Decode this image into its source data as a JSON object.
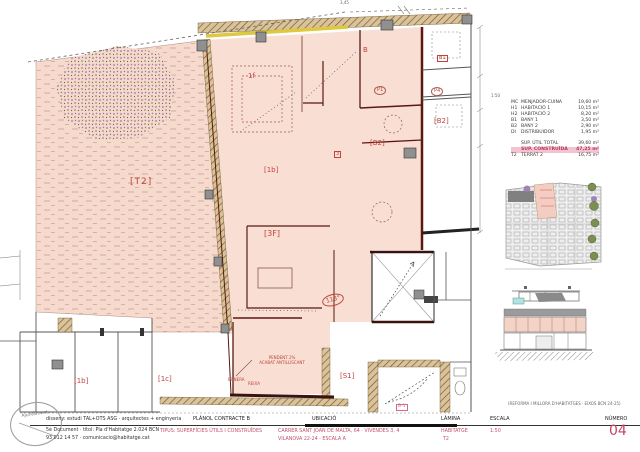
{
  "plan": {
    "labels": {
      "t2": "[T2]",
      "room_1f": "1f",
      "room_b": "B",
      "p1": "P1",
      "b2_right_top": "[B2]",
      "box_3": "3",
      "room_1b_mid": "[1b]",
      "room_3f": "[3F]",
      "angle": "113°",
      "pend_line1": "PENDENT 2%",
      "pend_line2": "ACABAT ANTILLISCANT",
      "drain_left": "BUNERA",
      "drain_right": "REIXA",
      "s1": "[S1]",
      "stair_tag": "B-1",
      "nb_b1": "B1",
      "nb_p4": "P4",
      "nb_b2": "[B2]",
      "nb_1b": "[1b]",
      "nb_1c": "[1c]",
      "dim_top": "3,45",
      "scale_note": "1:50"
    }
  },
  "legend": {
    "rows": [
      {
        "code": "MC",
        "name": "MENJADOR-CUINA",
        "area": "19,60 m²"
      },
      {
        "code": "H1",
        "name": "HABITACIÓ 1",
        "area": "10,15 m²"
      },
      {
        "code": "H2",
        "name": "HABITACIÓ 2",
        "area": "8,20 m²"
      },
      {
        "code": "B1",
        "name": "BANY 1",
        "area": "3,50 m²"
      },
      {
        "code": "B2",
        "name": "BANY 2",
        "area": "2,90 m²"
      },
      {
        "code": "DI",
        "name": "DISTRIBUIDOR",
        "area": "1,95 m²"
      }
    ],
    "totals": [
      {
        "code": "",
        "name": "SUP. ÚTIL TOTAL",
        "area": "39,60 m²"
      },
      {
        "code": "",
        "name": "SUP. CONSTRUÏDA",
        "area": "47,25 m²"
      },
      {
        "code": "T2",
        "name": "TERRAT 2",
        "area": "16,75 m²"
      }
    ]
  },
  "titleblock": {
    "stamp": "Ajuntament",
    "studio_line": "disseny: estudi TAL+OTS ASG · arquitectes + enginyeria",
    "doc_line1": "5è Document · títol: Pla d'Habitatge 2.024 BCN",
    "doc_line2": "93 012 14 57 · comunicacio@habitatge.cat",
    "planol_label": "PLÀNOL CONTRACTE B",
    "planol_value": "TIPUS: SUPERFÍCIES ÚTILS I CONSTRUÏDES",
    "ubicacio_label": "UBICACIÓ",
    "ubicacio_line1": "CARRER SANT JOAN DE MALTA, 64 · VIVENDES 3, 4",
    "ubicacio_line2": "VILANOVA 22-24 · ESCALA A",
    "lamina_label": "LÀMINA",
    "lamina_line1": "HABITATGE",
    "lamina_line2": "T2",
    "escala_label": "ESCALA",
    "escala_value": "1:50",
    "numero_label": "NÚMERO",
    "numero_value": "04",
    "ref_note": "(REFORMA I MILLORA D'HABITATGES · EIXOS BCN 24-25)"
  },
  "colors": {
    "wall": "#5a1912",
    "floor": "#f8ded3",
    "label_red": "#c0453f",
    "label_pink": "#cf6d86",
    "highlight_row": "#f3c3cf",
    "sheet_number": "#c54562",
    "insulation": "#ddc83f"
  }
}
